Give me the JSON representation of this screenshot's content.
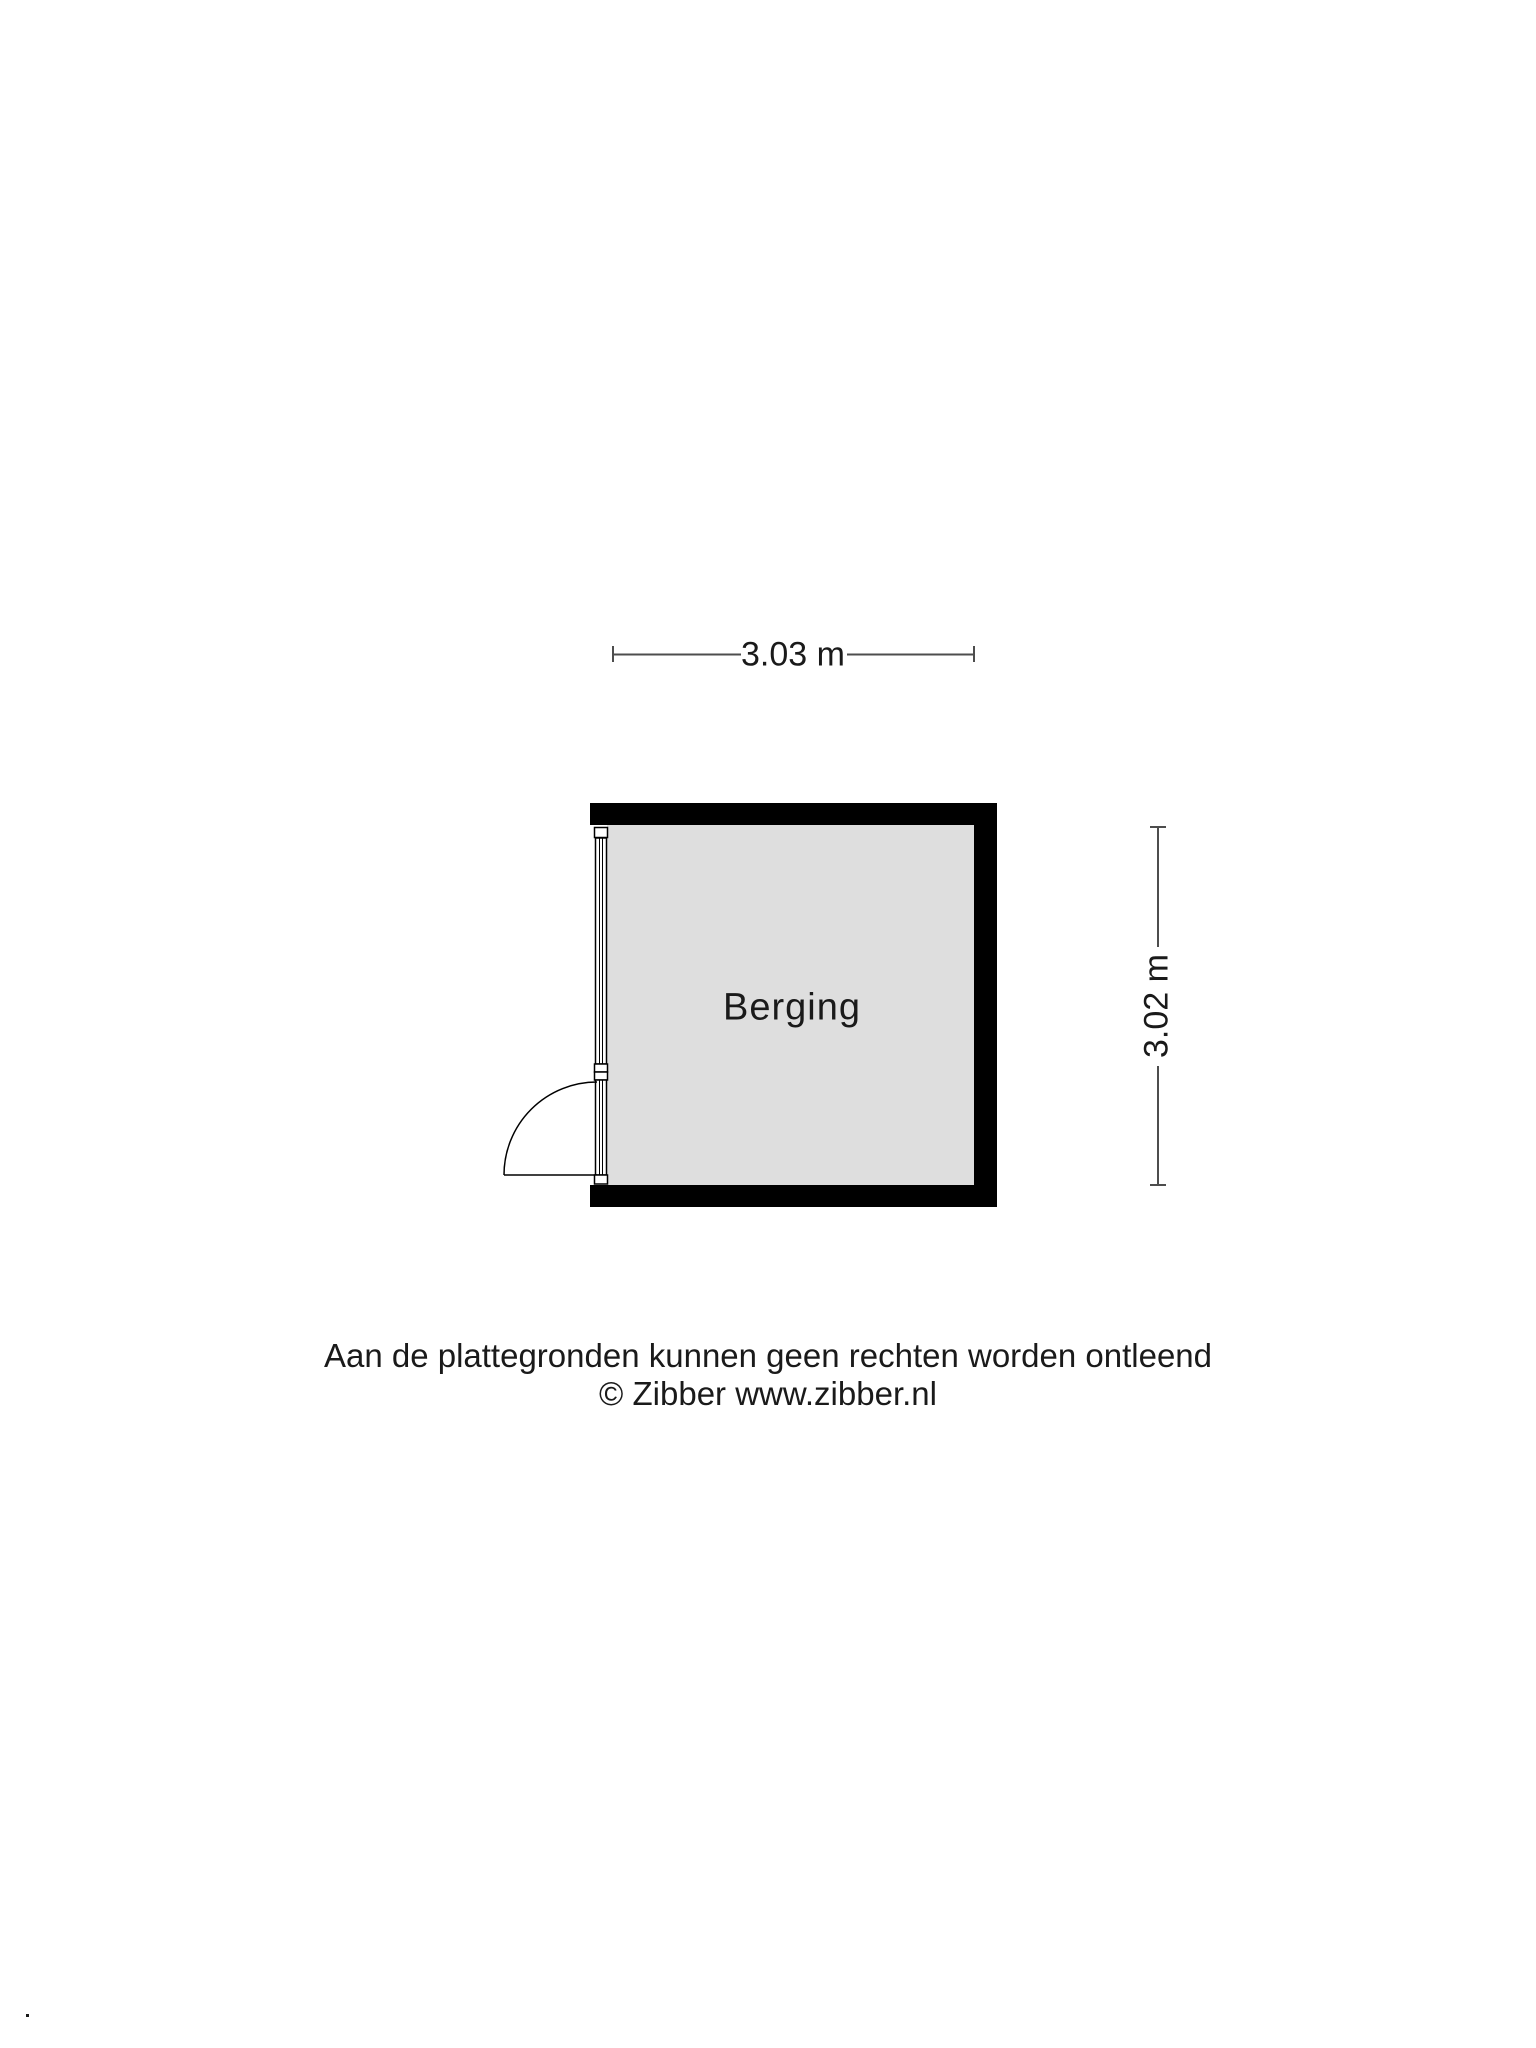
{
  "floorplan": {
    "room": {
      "name": "Berging"
    },
    "dimensions": {
      "width_label": "3.03 m",
      "height_label": "3.02 m"
    },
    "footer": {
      "line1": "Aan de plattegronden kunnen geen rechten worden ontleend",
      "line2": "© Zibber www.zibber.nl"
    },
    "stray_mark": ".",
    "colors": {
      "wall": "#000000",
      "floor": "#dedede",
      "frame": "#000000",
      "dimension_line": "#4d4d4d",
      "text": "#1a1a1a",
      "background": "#ffffff"
    }
  }
}
